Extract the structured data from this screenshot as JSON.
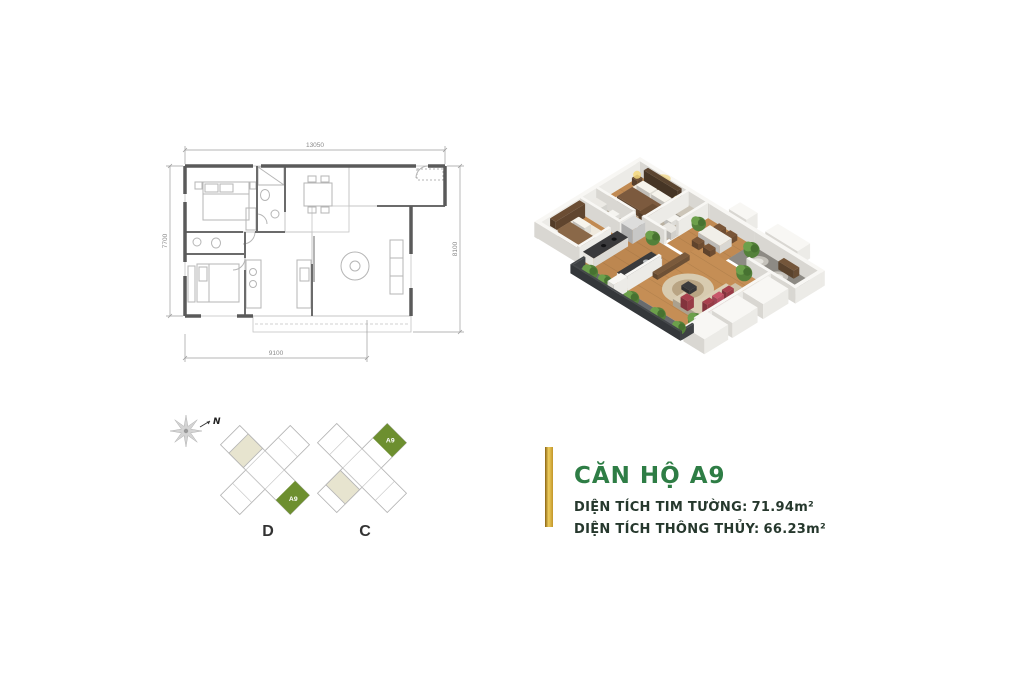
{
  "floorplan_2d": {
    "dimensions": {
      "top": "13050",
      "left": "7700",
      "right": "8100",
      "bottom": "9100"
    }
  },
  "site_diagrams": {
    "compass_label": "N",
    "towers": [
      {
        "label": "D",
        "unit_label": "A9"
      },
      {
        "label": "C",
        "unit_label": "A9"
      }
    ],
    "unit_highlight_color": "#6d8f2f",
    "alt_unit_color": "#e7e4cf"
  },
  "unit_info": {
    "title": "CĂN HỘ A9",
    "accent_color": "#2e7d45",
    "gold_bar_colors": [
      "#8a6414",
      "#eecd5d",
      "#c2962a"
    ],
    "rows": [
      {
        "label": "DIỆN TÍCH TIM TƯỜNG:",
        "value": "71.94m²"
      },
      {
        "label": "DIỆN TÍCH THÔNG THỦY:",
        "value": "66.23m²"
      }
    ]
  }
}
